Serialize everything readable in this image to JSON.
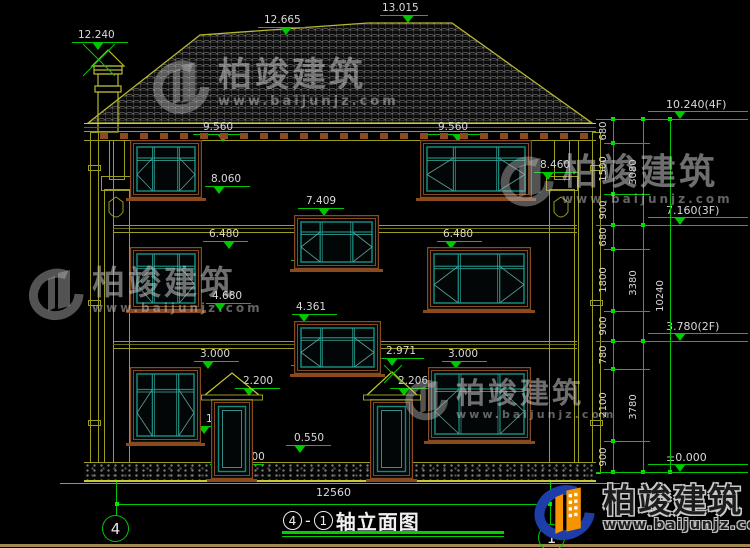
{
  "watermark": {
    "brand": "柏竣建筑",
    "url": "www.baijunjz.com"
  },
  "title_block": {
    "ref_a": "4",
    "dash": "-",
    "ref_b": "1",
    "name": "轴立面图",
    "axis_left": "4",
    "axis_right": "1",
    "overall_width": "12560"
  },
  "drawing": {
    "facade_markers": [
      {
        "label": "12.240",
        "x": 72,
        "y": 50,
        "w": 56,
        "t": 20,
        "lx": 0
      },
      {
        "label": "12.665",
        "x": 258,
        "y": 35,
        "w": 48,
        "t": 22,
        "lx": 0
      },
      {
        "label": "13.015",
        "x": 380,
        "y": 23,
        "w": 48,
        "t": 22,
        "lx": 2
      },
      {
        "label": "9.560",
        "x": 193,
        "y": 142,
        "w": 52,
        "t": 24,
        "lx": 10
      },
      {
        "label": "8.060",
        "x": 205,
        "y": 194,
        "w": 45,
        "t": 8,
        "lx": 6
      },
      {
        "label": "9.560",
        "x": 428,
        "y": 142,
        "w": 52,
        "t": 24,
        "lx": 10
      },
      {
        "label": "8.090",
        "x": 426,
        "y": 193,
        "w": 45,
        "t": 8,
        "lx": 6
      },
      {
        "label": "8.460",
        "x": 534,
        "y": 180,
        "w": 44,
        "t": 8,
        "lx": 6
      },
      {
        "label": "7.409",
        "x": 298,
        "y": 216,
        "w": 46,
        "t": 20,
        "lx": 8
      },
      {
        "label": "5.909",
        "x": 291,
        "y": 268,
        "w": 45,
        "t": 6,
        "lx": 4
      },
      {
        "label": "6.480",
        "x": 203,
        "y": 249,
        "w": 45,
        "t": 20,
        "lx": 6
      },
      {
        "label": "4.680",
        "x": 206,
        "y": 311,
        "w": 45,
        "t": 8,
        "lx": 6
      },
      {
        "label": "6.480",
        "x": 437,
        "y": 249,
        "w": 45,
        "t": 8,
        "lx": 6
      },
      {
        "label": "4.680",
        "x": 437,
        "y": 311,
        "w": 45,
        "t": 8,
        "lx": 6
      },
      {
        "label": "4.361",
        "x": 292,
        "y": 322,
        "w": 45,
        "t": 6,
        "lx": 4
      },
      {
        "label": "2.861",
        "x": 291,
        "y": 373,
        "w": 45,
        "t": 6,
        "lx": 4
      },
      {
        "label": "3.000",
        "x": 194,
        "y": 369,
        "w": 45,
        "t": 8,
        "lx": 6
      },
      {
        "label": "3.000",
        "x": 442,
        "y": 369,
        "w": 45,
        "t": 8,
        "lx": 6
      },
      {
        "label": "2.971",
        "x": 380,
        "y": 366,
        "w": 44,
        "t": 6,
        "lx": 6
      },
      {
        "label": "2.200",
        "x": 235,
        "y": 396,
        "w": 45,
        "t": 8,
        "lx": 8
      },
      {
        "label": "2.206",
        "x": 390,
        "y": 396,
        "w": 44,
        "t": 8,
        "lx": 8
      },
      {
        "label": "1.100",
        "x": 196,
        "y": 434,
        "w": 44,
        "t": 2,
        "lx": 10
      },
      {
        "label": "0.900",
        "x": 440,
        "y": 441,
        "w": 45,
        "t": 8,
        "lx": 6
      },
      {
        "label": "0.550",
        "x": 286,
        "y": 453,
        "w": 45,
        "t": 8,
        "lx": 8
      },
      {
        "label": "±0.000",
        "x": 210,
        "y": 472,
        "w": 54,
        "t": 8,
        "lx": 16
      }
    ],
    "level_markers": [
      {
        "label": "10.240(4F)",
        "x": 648,
        "y": 119,
        "w": 100,
        "t": 26,
        "lx": 18
      },
      {
        "label": "7.160(3F)",
        "x": 648,
        "y": 225,
        "w": 100,
        "t": 26,
        "lx": 18
      },
      {
        "label": "3.780(2F)",
        "x": 648,
        "y": 341,
        "w": 100,
        "t": 26,
        "lx": 18
      },
      {
        "label": "±0.000",
        "x": 648,
        "y": 472,
        "w": 100,
        "t": 26,
        "lx": 18
      }
    ],
    "chains": [
      {
        "x": 613,
        "segments": [
          {
            "v": "680",
            "y1": 119,
            "y2": 143
          },
          {
            "v": "1500",
            "y1": 143,
            "y2": 194
          },
          {
            "v": "900",
            "y1": 194,
            "y2": 225
          },
          {
            "v": "680",
            "y1": 225,
            "y2": 249
          },
          {
            "v": "1800",
            "y1": 249,
            "y2": 311
          },
          {
            "v": "900",
            "y1": 311,
            "y2": 341
          },
          {
            "v": "780",
            "y1": 341,
            "y2": 369
          },
          {
            "v": "2100",
            "y1": 369,
            "y2": 441
          },
          {
            "v": "900",
            "y1": 441,
            "y2": 472
          }
        ]
      },
      {
        "x": 643,
        "segments": [
          {
            "v": "3080",
            "y1": 119,
            "y2": 225
          },
          {
            "v": "3380",
            "y1": 225,
            "y2": 341
          },
          {
            "v": "3780",
            "y1": 341,
            "y2": 472
          }
        ]
      },
      {
        "x": 670,
        "segments": [
          {
            "v": "10240",
            "y1": 119,
            "y2": 472
          }
        ]
      }
    ],
    "level_lines": [
      119,
      225,
      341,
      472
    ],
    "tick_lines": [
      143,
      194,
      249,
      311,
      369,
      441
    ],
    "windows": [
      {
        "x": 130,
        "y": 140,
        "w": 72,
        "h": 58,
        "kind": "win"
      },
      {
        "x": 420,
        "y": 140,
        "w": 112,
        "h": 58,
        "kind": "win"
      },
      {
        "x": 294,
        "y": 215,
        "w": 85,
        "h": 54,
        "kind": "win"
      },
      {
        "x": 130,
        "y": 247,
        "w": 72,
        "h": 63,
        "kind": "win"
      },
      {
        "x": 427,
        "y": 247,
        "w": 104,
        "h": 63,
        "kind": "win"
      },
      {
        "x": 294,
        "y": 321,
        "w": 87,
        "h": 53,
        "kind": "win"
      },
      {
        "x": 130,
        "y": 367,
        "w": 71,
        "h": 76,
        "kind": "win"
      },
      {
        "x": 428,
        "y": 367,
        "w": 103,
        "h": 74,
        "kind": "win"
      },
      {
        "x": 211,
        "y": 399,
        "w": 42,
        "h": 80,
        "kind": "door"
      },
      {
        "x": 370,
        "y": 399,
        "w": 43,
        "h": 80,
        "kind": "door"
      }
    ],
    "pediments": [
      {
        "x": 201,
        "y": 371,
        "w": 62,
        "h": 32
      },
      {
        "x": 363,
        "y": 370,
        "w": 58,
        "h": 33
      }
    ],
    "crosses": [
      {
        "cx": 99,
        "cy": 60,
        "r": 16
      },
      {
        "cx": 393,
        "cy": 374,
        "r": 9
      }
    ],
    "dentils": {
      "x1": 100,
      "x2": 584,
      "step": 20,
      "y": 133,
      "w": 8,
      "h": 6
    },
    "watermarks": [
      {
        "x": 146,
        "y": 58,
        "brand_size": 34,
        "url_size": 13,
        "swirl": 66
      },
      {
        "x": 22,
        "y": 266,
        "brand_size": 33,
        "url_size": 12,
        "swirl": 64
      },
      {
        "x": 494,
        "y": 154,
        "brand_size": 36,
        "url_size": 12,
        "swirl": 62
      },
      {
        "x": 400,
        "y": 378,
        "brand_size": 29,
        "url_size": 11,
        "swirl": 50
      }
    ],
    "bottom_dim": {
      "x1": 117,
      "x2": 550,
      "y": 504
    }
  }
}
